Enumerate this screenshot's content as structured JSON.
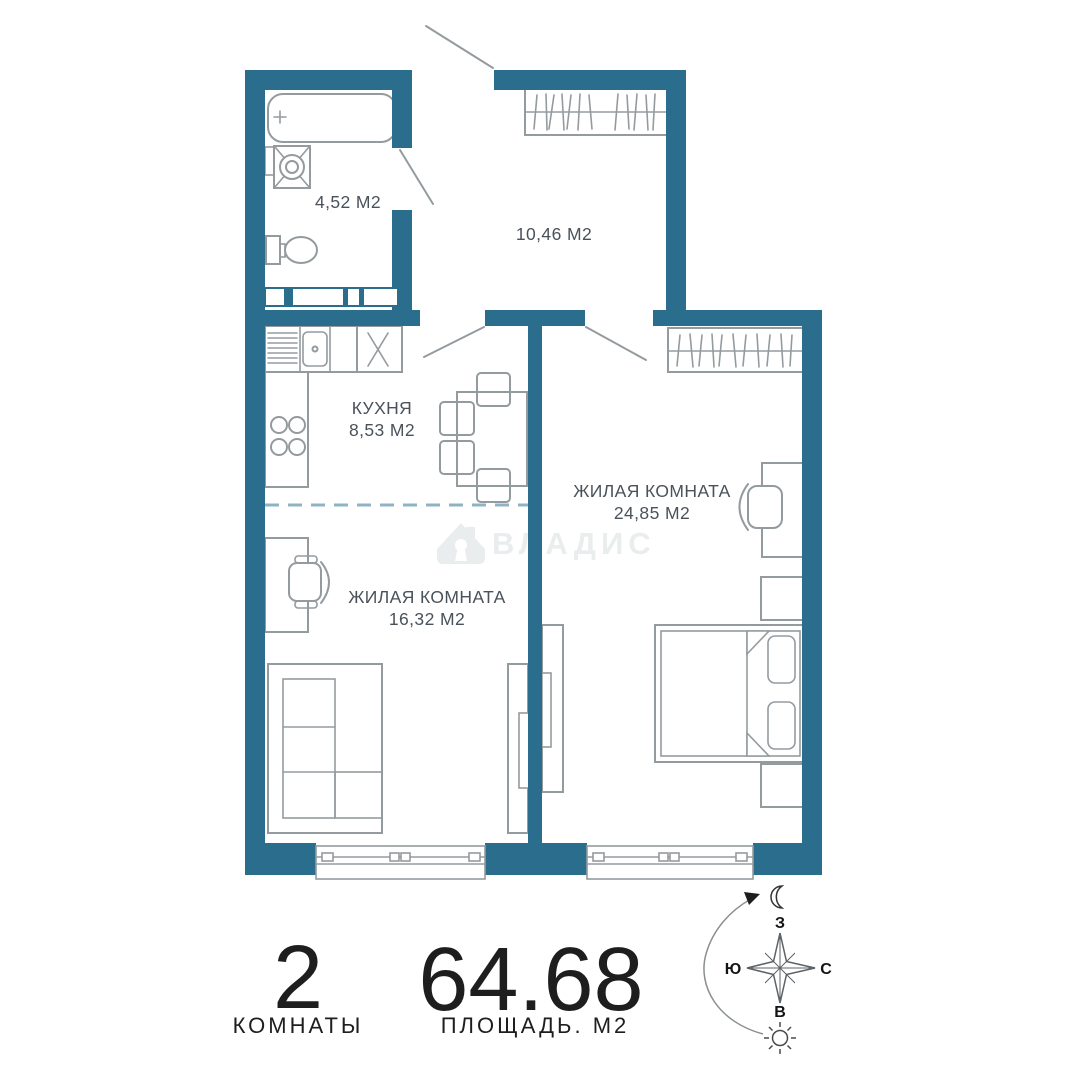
{
  "colors": {
    "wall": "#2b6d8c",
    "furniture": "#949b9f",
    "dashed": "#8fb3c4",
    "label": "#49525a",
    "watermark": "#eaedee",
    "stats": "#1e1e1e",
    "compass": "#5c6266"
  },
  "rooms": {
    "bathroom": {
      "area": "4,52 М2"
    },
    "hallway": {
      "area": "10,46 М2"
    },
    "kitchen": {
      "name": "КУХНЯ",
      "area": "8,53 М2"
    },
    "living_large": {
      "name": "ЖИЛАЯ КОМНАТА",
      "area": "24,85 М2"
    },
    "living_small": {
      "name": "ЖИЛАЯ КОМНАТА",
      "area": "16,32 М2"
    }
  },
  "watermark": {
    "text": "ВЛАДИС"
  },
  "stats": {
    "rooms_value": "2",
    "rooms_label": "КОМНАТЫ",
    "area_value": "64.68",
    "area_label": "ПЛОЩАДЬ. М2"
  },
  "compass": {
    "west": "З",
    "south": "Ю",
    "north": "С",
    "east": "В"
  }
}
